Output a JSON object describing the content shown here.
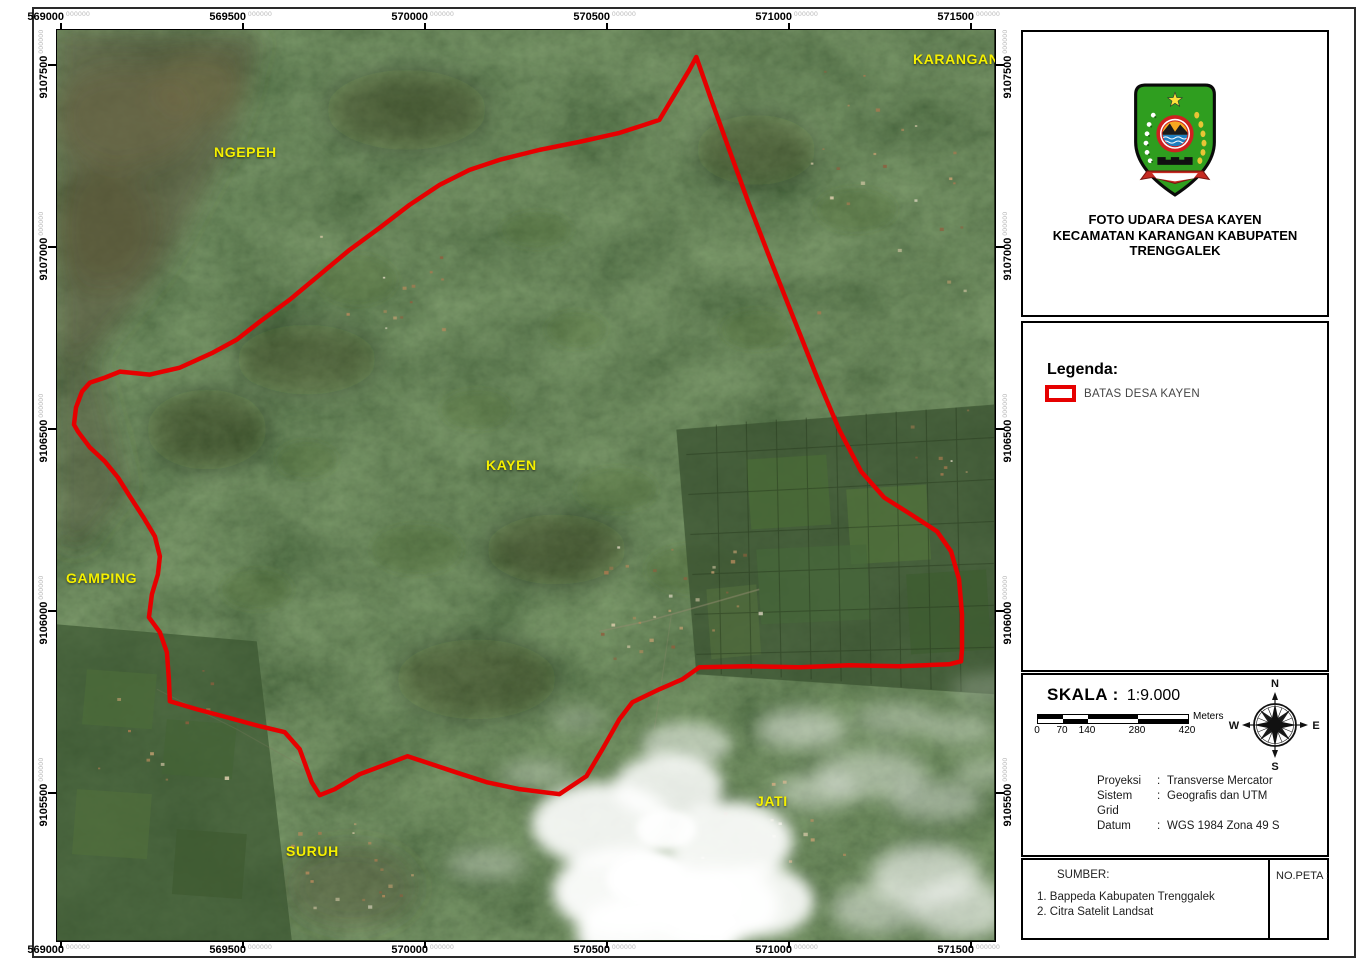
{
  "map": {
    "place_labels": [
      {
        "text": "KARANGAN",
        "x": 856,
        "y": 21
      },
      {
        "text": "NGEPEH",
        "x": 157,
        "y": 114
      },
      {
        "text": "KAYEN",
        "x": 429,
        "y": 427
      },
      {
        "text": "GAMPING",
        "x": 9,
        "y": 540
      },
      {
        "text": "SURUH",
        "x": 229,
        "y": 813
      },
      {
        "text": "JATI",
        "x": 699,
        "y": 763
      }
    ]
  },
  "grid": {
    "x_ticks": [
      {
        "label": "569000",
        "suffix": "000000",
        "x": 60
      },
      {
        "label": "569500",
        "suffix": "000000",
        "x": 242
      },
      {
        "label": "570000",
        "suffix": "000000",
        "x": 424
      },
      {
        "label": "570500",
        "suffix": "000000",
        "x": 606
      },
      {
        "label": "571000",
        "suffix": "000000",
        "x": 788
      },
      {
        "label": "571500",
        "suffix": "000000",
        "x": 970
      }
    ],
    "y_ticks": [
      {
        "label": "9107500",
        "suffix": "000000",
        "y": 64
      },
      {
        "label": "9107000",
        "suffix": "000000",
        "y": 246
      },
      {
        "label": "9106500",
        "suffix": "000000",
        "y": 428
      },
      {
        "label": "9106000",
        "suffix": "000000",
        "y": 610
      },
      {
        "label": "9105500",
        "suffix": "000000",
        "y": 792
      }
    ]
  },
  "title_box": {
    "line1": "FOTO UDARA DESA KAYEN",
    "line2": "KECAMATAN KARANGAN KABUPATEN TRENGGALEK"
  },
  "legend": {
    "heading": "Legenda:",
    "items": [
      {
        "label": "BATAS DESA KAYEN"
      }
    ]
  },
  "scale": {
    "heading": "SKALA :",
    "ratio": "1:9.000",
    "ticks": [
      "0",
      "70",
      "140",
      "280",
      "420"
    ],
    "unit": "Meters"
  },
  "compass": {
    "north": "N",
    "east": "E",
    "south": "S",
    "west": "W"
  },
  "projection": {
    "rows": [
      {
        "label": "Proyeksi",
        "sep": ":",
        "value": "Transverse Mercator"
      },
      {
        "label": "Sistem Grid",
        "sep": ":",
        "value": "Geografis dan UTM"
      },
      {
        "label": "Datum",
        "sep": ":",
        "value": "WGS 1984 Zona 49 S"
      }
    ]
  },
  "source": {
    "heading": "SUMBER:",
    "items": [
      "1. Bappeda Kabupaten Trenggalek",
      "2. Citra Satelit Landsat"
    ],
    "map_no": "NO.PETA :"
  },
  "colors": {
    "boundary": "#e60000",
    "place_label": "#f5f000",
    "grid_suffix": "#b5b5b5"
  }
}
